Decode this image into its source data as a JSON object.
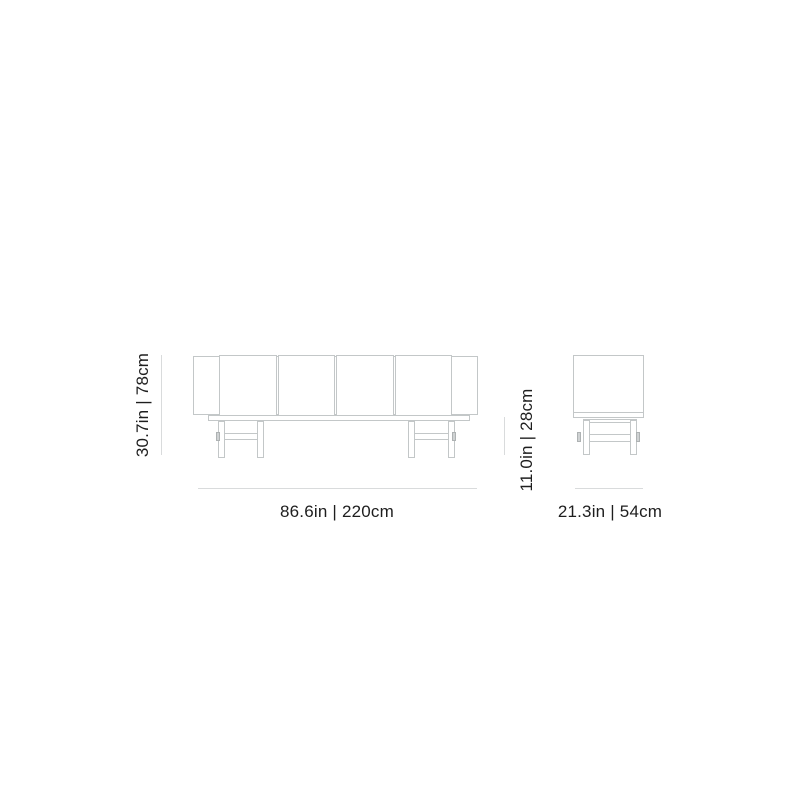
{
  "drawing": {
    "subject": "sideboard-dimension-diagram",
    "views": {
      "front": {
        "height_label": "30.7in | 78cm",
        "width_label": "86.6in | 220cm",
        "door_count": 4
      },
      "side": {
        "height_label": "11.0in | 28cm",
        "width_label": "21.3in | 54cm"
      }
    },
    "dimensions": {
      "width": {
        "in": "86.6",
        "cm": "220"
      },
      "height": {
        "in": "30.7",
        "cm": "78"
      },
      "depth": {
        "in": "21.3",
        "cm": "54"
      },
      "leg_height": {
        "in": "11.0",
        "cm": "28"
      }
    },
    "colors": {
      "outline": "#c3c7c8",
      "dimension_line": "#d9dbdc",
      "text": "#1e1e1e",
      "background": "#ffffff"
    }
  }
}
